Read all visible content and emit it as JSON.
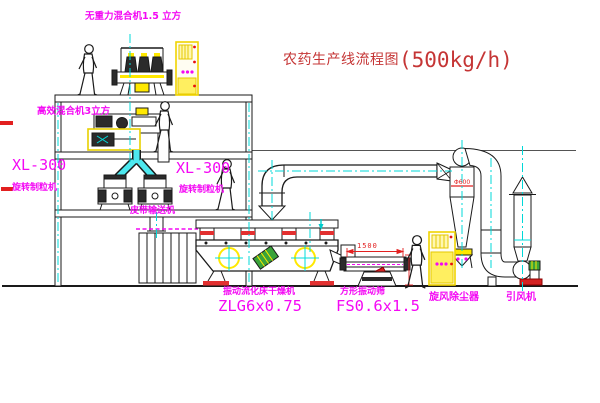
{
  "title": {
    "text": "农药生产线流程图",
    "capacity": "(500kg/h)"
  },
  "labels": {
    "top_mixer": "无重力混合机1.5 立方",
    "mixer_2f": "高效混合机3立方",
    "granulator_left_model": "XL-300",
    "granulator_left_name": "旋转制粒机",
    "granulator_right_model": "XL-300",
    "granulator_right_name": "旋转制粒机",
    "belt_conveyor": "皮带输送机",
    "dryer_name": "振动流化床干燥机",
    "dryer_model": "ZLG6x0.75",
    "screen_name": "方形振动筛",
    "screen_model": "FS0.6x1.5",
    "cyclone": "旋风除尘器",
    "fan": "引风机"
  },
  "dimensions": {
    "screen_length": "1500",
    "cyclone_note": "Φ600"
  },
  "colors": {
    "label_magenta": "#f408f4",
    "title_red": "#c53535",
    "centerline_cyan": "#00dddd",
    "machine_yellow": "#ffe800",
    "accent_red": "#e22020",
    "line_black": "#1a1a1a"
  }
}
